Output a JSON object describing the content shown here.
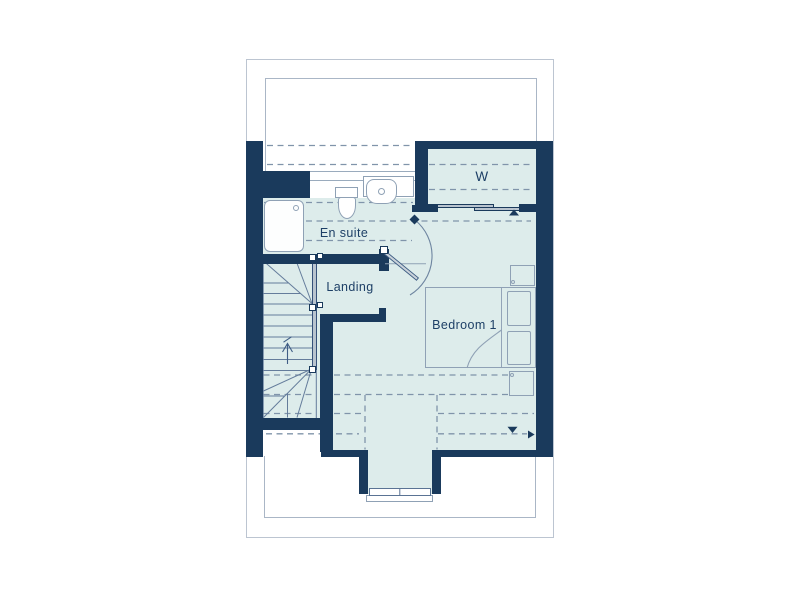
{
  "floorplan": {
    "title": "First floor plan",
    "rooms": [
      {
        "id": "wardrobe",
        "label": "W"
      },
      {
        "id": "ensuite",
        "label": "En suite"
      },
      {
        "id": "landing",
        "label": "Landing"
      },
      {
        "id": "bedroom1",
        "label": "Bedroom 1"
      }
    ],
    "fixtures": [
      "shower-tray",
      "toilet",
      "washbasin",
      "winder-staircase",
      "double-bed",
      "pillows",
      "bedside-cabinet-top",
      "bedside-cabinet-bottom",
      "wardrobe-sliding-doors",
      "dormer-window",
      "door-swing-arc",
      "reduced-head-height-dashed-lines",
      "direction-arrow-markers"
    ],
    "colors": {
      "wall": "#1a3a5c",
      "room_fill": "#ddeceb",
      "fixture_line": "#8fa1b5",
      "dashed_line": "#8094aa",
      "text": "#1d3f66",
      "rail_fill": "#b9c4cf",
      "outer_border": "#bcc5d1",
      "background": "#ffffff"
    }
  }
}
